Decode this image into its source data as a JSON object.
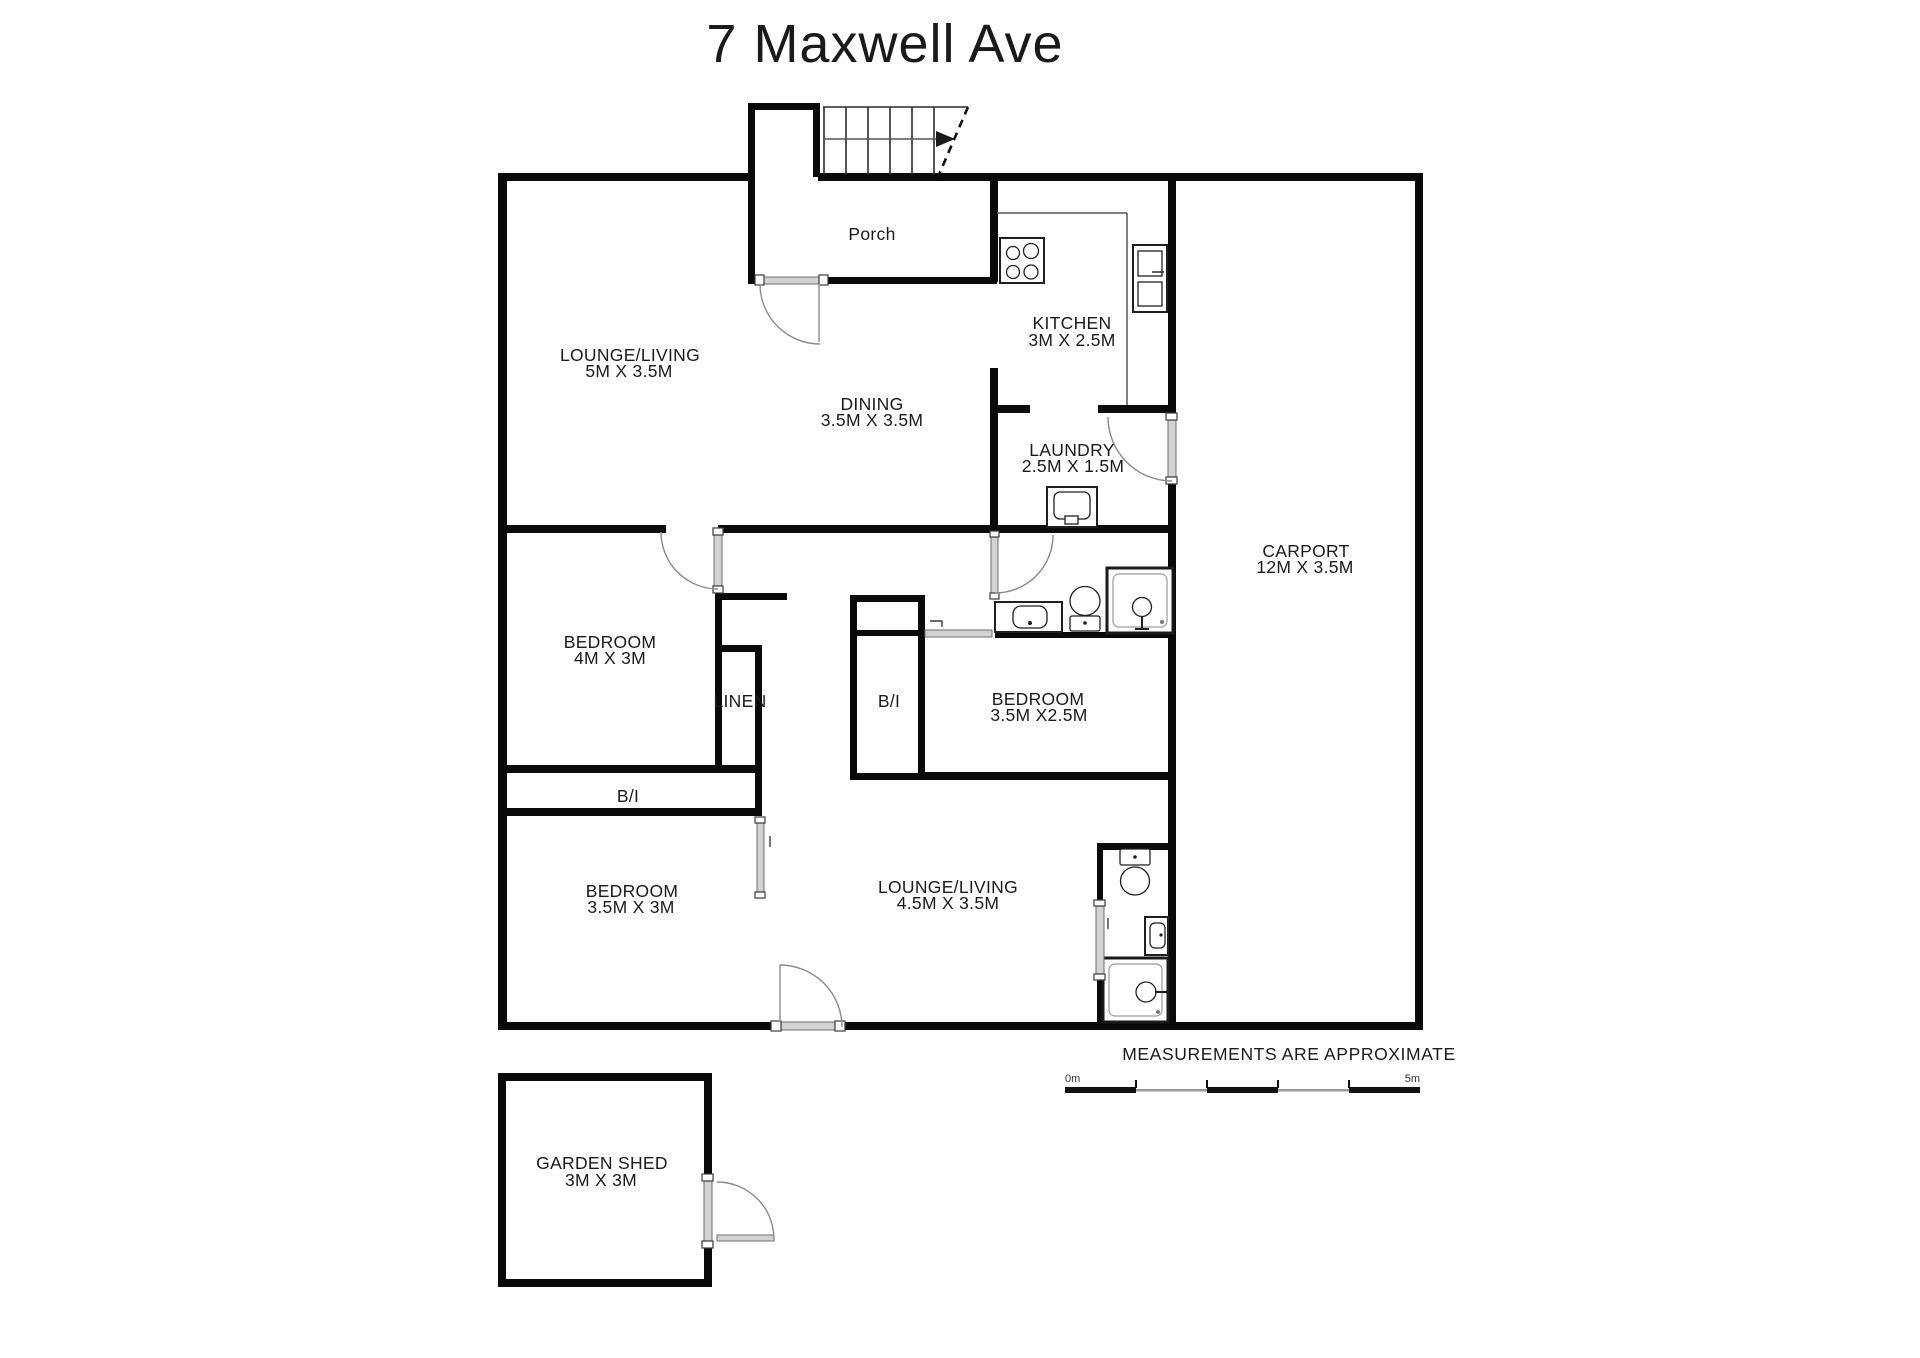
{
  "title": "7 Maxwell Ave",
  "rooms": {
    "porch": {
      "name": "Porch"
    },
    "lounge_top": {
      "name": "LOUNGE/LIVING",
      "dims": "5M X 3.5M"
    },
    "dining": {
      "name": "DINING",
      "dims": "3.5M X 3.5M"
    },
    "kitchen": {
      "name": "KITCHEN",
      "dims": "3M X 2.5M"
    },
    "laundry": {
      "name": "LAUNDRY",
      "dims": "2.5M X 1.5M"
    },
    "carport": {
      "name": "CARPORT",
      "dims": "12M X 3.5M"
    },
    "bedroom1": {
      "name": "BEDROOM",
      "dims": "4M X 3M"
    },
    "linen": {
      "name": "LINEN"
    },
    "bi_closet": {
      "name": "B/I"
    },
    "bedroom2": {
      "name": "BEDROOM",
      "dims": "3.5M X2.5M"
    },
    "bi_strip": {
      "name": "B/I"
    },
    "bedroom3": {
      "name": "BEDROOM",
      "dims": "3.5M X 3M"
    },
    "lounge_bottom": {
      "name": "LOUNGE/LIVING",
      "dims": "4.5M X 3.5M"
    },
    "garden_shed": {
      "name": "GARDEN SHED",
      "dims": "3M X 3M"
    }
  },
  "footer": {
    "disclaimer": "MEASUREMENTS ARE APPROXIMATE",
    "scale_start": "0m",
    "scale_end": "5m"
  },
  "colors": {
    "wall": "#0a0a0a",
    "door_gray": "#d2d2d2",
    "scale_gray": "#999999",
    "text": "#1a1a1a",
    "background": "#ffffff"
  }
}
